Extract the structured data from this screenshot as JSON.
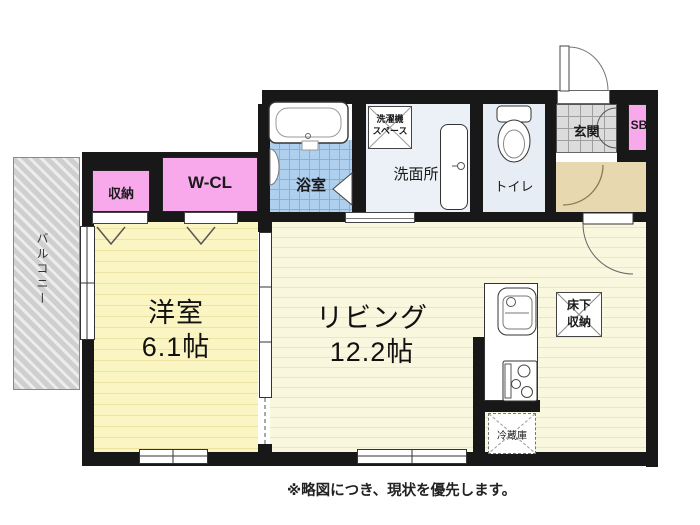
{
  "plan": {
    "note": "※略図につき、現状を優先します。",
    "rooms": {
      "balcony": {
        "label": "バルコニー"
      },
      "storage": {
        "label": "収納"
      },
      "walk_in_closet": {
        "label": "W-CL"
      },
      "bathroom": {
        "label": "浴室"
      },
      "laundry_space": {
        "label_line1": "洗濯機",
        "label_line2": "スペース"
      },
      "washroom": {
        "label": "洗面所"
      },
      "toilet": {
        "label": "トイレ"
      },
      "entrance": {
        "label": "玄関"
      },
      "shoe_box": {
        "label": "SB"
      },
      "western_room": {
        "label": "洋室",
        "size": "6.1帖"
      },
      "living": {
        "label": "リビング",
        "size": "12.2帖"
      },
      "underfloor_storage": {
        "label_line1": "床下",
        "label_line2": "収納"
      },
      "refrigerator": {
        "label": "冷蔵庫"
      }
    },
    "colors": {
      "wall": "#181818",
      "closet_pink": "#f7a9eb",
      "western_room_yellow": "#fbf5c3",
      "living_yellow": "#faf7df",
      "bath_tile_blue": "#aecfee",
      "wet_area_blue": "#ecf1f7",
      "entrance_gray": "#dcdcdc",
      "hallway_tan": "#e7d8b0",
      "balcony_gray": "#d9d9d9"
    }
  }
}
